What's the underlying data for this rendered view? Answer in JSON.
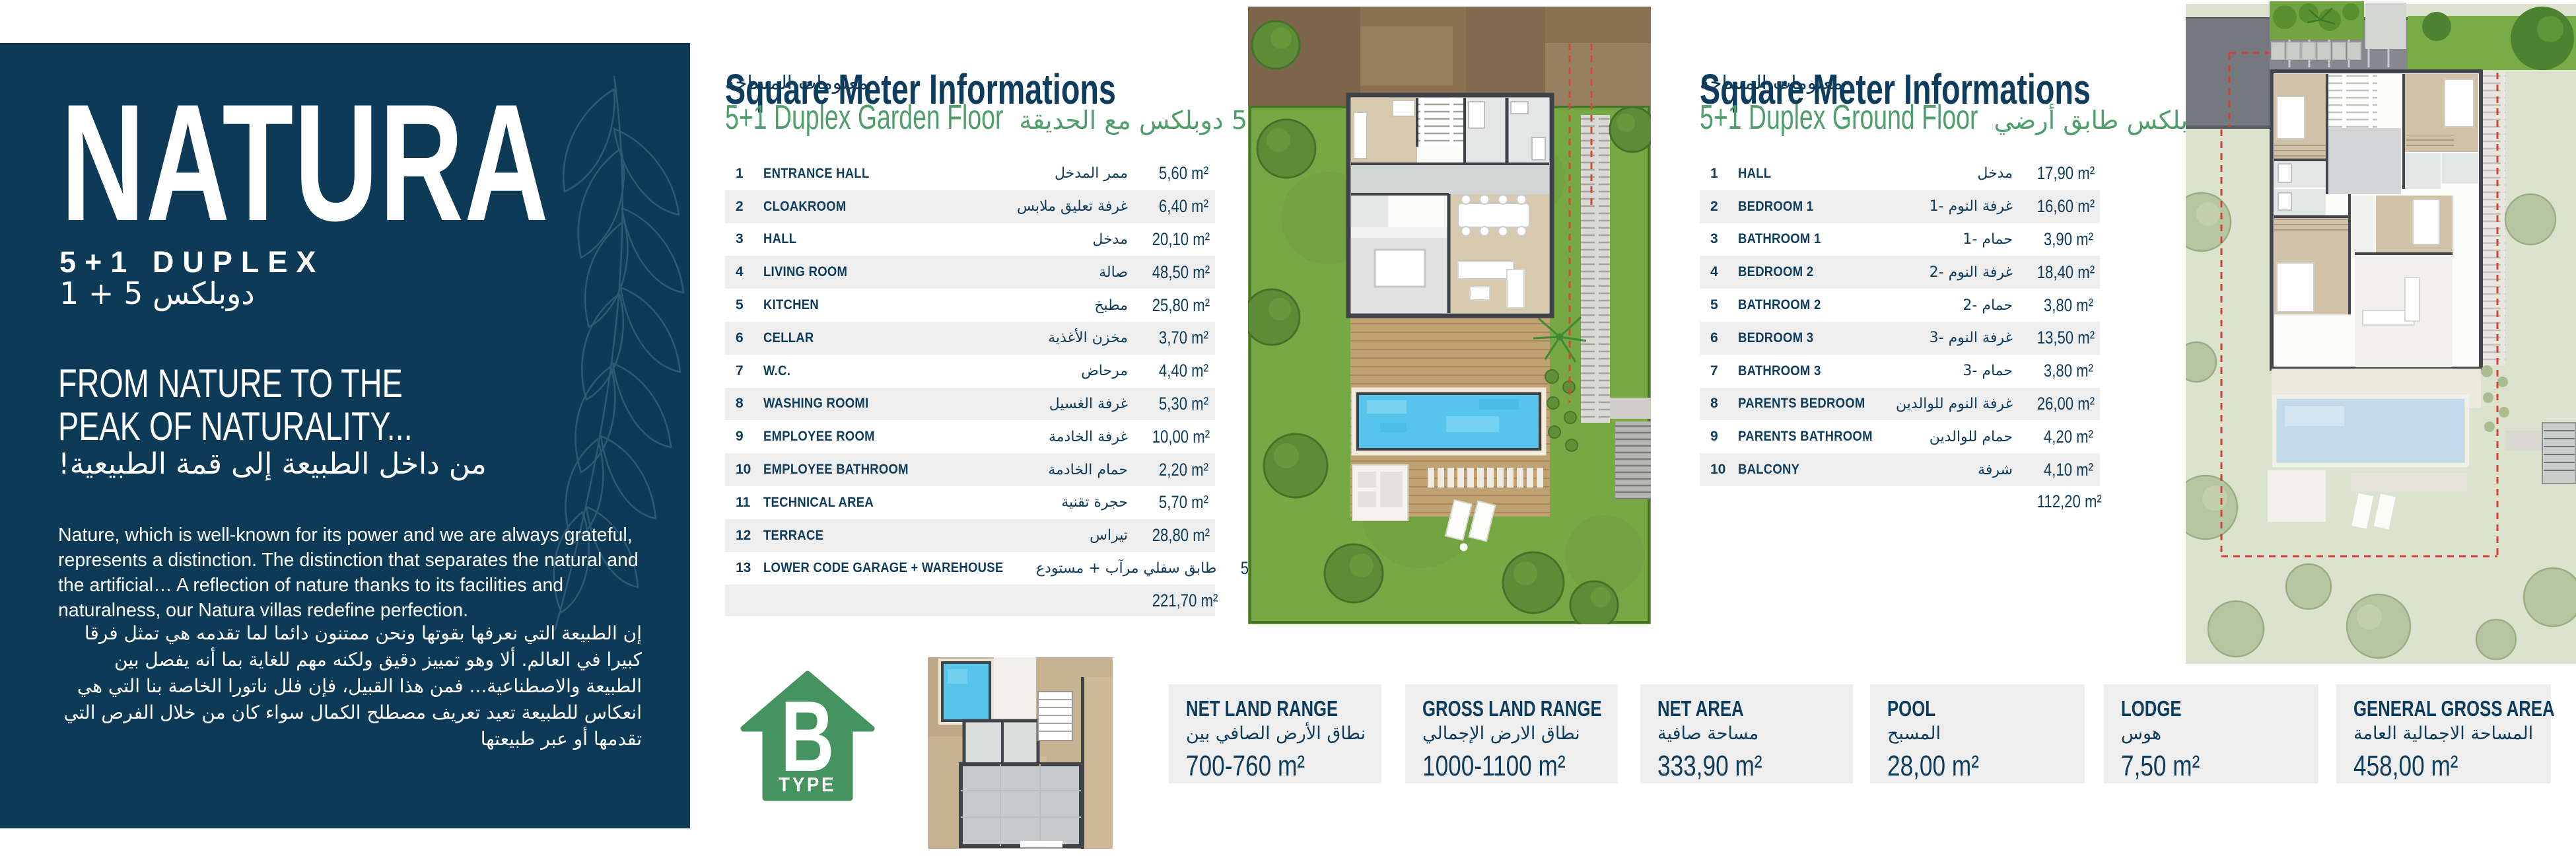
{
  "colors": {
    "navy": "#0d3a56",
    "heading_green": "#4f9e6c",
    "badge_green": "#45935f",
    "row_stripe": "#eeeeef",
    "box_background": "#eeeeef",
    "garden_green": "#76a844",
    "pool_blue": "#58c6ec"
  },
  "left_panel": {
    "title": "NATURA",
    "type_line": "5+1 DUPLEX",
    "type_line_ar": "دوبلكس 5 + 1",
    "headline1": "FROM NATURE TO THE",
    "headline2": "PEAK OF NATURALITY...",
    "headline_ar": "من داخل الطبيعة إلى قمة الطبيعية!",
    "body_en": "Nature, which is well-known for its power and we are always grateful, represents a distinction. The distinction that separates the natural and the artificial…  A reflection of nature thanks to its facilities and naturalness, our Natura villas redefine perfection.",
    "body_ar": "إن الطبيعة التي نعرفها بقوتها ونحن ممتنون دائما لما تقدمه هي تمثل فرقا كبيرا في العالم. ألا وهو تمييز دقيق ولكنه مهم للغاية بما أنه يفصل بين الطبيعة والاصطناعية... فمن هذا القبيل، فإن فلل ناتورا الخاصة بنا التي هي انعكاس للطبيعة تعيد تعريف مصطلح الكمال سواء كان من خلال الفرص التي تقدمها أو عبر طبيعتها"
  },
  "garden_floor": {
    "heading": "Square Meter Informations",
    "heading_ar": "معلومات المساحة",
    "floor": "5+1 Duplex Garden Floor",
    "floor_ar": "5+1 دوبلكس مع الحديقة",
    "rows": [
      {
        "num": "1",
        "name": "ENTRANCE HALL",
        "name_ar": "ممر المدخل",
        "area": "5,60 m²"
      },
      {
        "num": "2",
        "name": "CLOAKROOM",
        "name_ar": "غرفة تعليق ملابس",
        "area": "6,40 m²"
      },
      {
        "num": "3",
        "name": "HALL",
        "name_ar": "مدخل",
        "area": "20,10 m²"
      },
      {
        "num": "4",
        "name": "LIVING ROOM",
        "name_ar": "صالة",
        "area": "48,50 m²"
      },
      {
        "num": "5",
        "name": "KITCHEN",
        "name_ar": "مطبخ",
        "area": "25,80 m²"
      },
      {
        "num": "6",
        "name": "CELLAR",
        "name_ar": "مخزن الأغذية",
        "area": "3,70 m²"
      },
      {
        "num": "7",
        "name": "W.C.",
        "name_ar": "مرحاض",
        "area": "4,40 m²"
      },
      {
        "num": "8",
        "name": "WASHING ROOMI",
        "name_ar": "غرفة الغسيل",
        "area": "5,30 m²"
      },
      {
        "num": "9",
        "name": "EMPLOYEE ROOM",
        "name_ar": "غرفة الخادمة",
        "area": "10,00 m²"
      },
      {
        "num": "10",
        "name": "EMPLOYEE BATHROOM",
        "name_ar": "حمام الخادمة",
        "area": "2,20 m²"
      },
      {
        "num": "11",
        "name": "TECHNICAL AREA",
        "name_ar": "حجرة تقنية",
        "area": "5,70 m²"
      },
      {
        "num": "12",
        "name": "TERRACE",
        "name_ar": "تيراس",
        "area": "28,80 m²"
      },
      {
        "num": "13",
        "name": "LOWER CODE GARAGE + WAREHOUSE",
        "name_ar": "طابق سفلي مرآب + مستودع",
        "area": "55,20 m²"
      }
    ],
    "total": "221,70 m²"
  },
  "ground_floor": {
    "heading": "Square Meter Informations",
    "heading_ar": "معلومات المساحة",
    "floor": "5+1 Duplex Ground Floor",
    "floor_ar": "5+1 دوبلكس طابق أرضي",
    "rows": [
      {
        "num": "1",
        "name": "HALL",
        "name_ar": "مدخل",
        "area": "17,90 m²"
      },
      {
        "num": "2",
        "name": "BEDROOM 1",
        "name_ar": "غرفة النوم -1",
        "area": "16,60 m²"
      },
      {
        "num": "3",
        "name": "BATHROOM 1",
        "name_ar": "حمام -1",
        "area": "3,90 m²"
      },
      {
        "num": "4",
        "name": "BEDROOM 2",
        "name_ar": "غرفة النوم -2",
        "area": "18,40 m²"
      },
      {
        "num": "5",
        "name": "BATHROOM 2",
        "name_ar": "حمام -2",
        "area": "3,80 m²"
      },
      {
        "num": "6",
        "name": "BEDROOM 3",
        "name_ar": "غرفة النوم -3",
        "area": "13,50 m²"
      },
      {
        "num": "7",
        "name": "BATHROOM 3",
        "name_ar": "حمام -3",
        "area": "3,80 m²"
      },
      {
        "num": "8",
        "name": "PARENTS BEDROOM",
        "name_ar": "غرفة النوم للوالدين",
        "area": "26,00 m²"
      },
      {
        "num": "9",
        "name": "PARENTS BATHROOM",
        "name_ar": "حمام للوالدين",
        "area": "4,20 m²"
      },
      {
        "num": "10",
        "name": "BALCONY",
        "name_ar": "شرفة",
        "area": "4,10 m²"
      }
    ],
    "total": "112,20 m²"
  },
  "type_badge": {
    "letter": "B",
    "word": "TYPE"
  },
  "summary_boxes": [
    {
      "title": "NET LAND RANGE",
      "title_ar": "نطاق الأرض الصافي بين",
      "value": "700-760 m²"
    },
    {
      "title": "GROSS LAND RANGE",
      "title_ar": "نطاق الارض الإجمالي",
      "value": "1000-1100 m²"
    },
    {
      "title": "NET AREA",
      "title_ar": "مساحة صافية",
      "value": "333,90 m²"
    },
    {
      "title": "POOL",
      "title_ar": "المسبح",
      "value": "28,00 m²"
    },
    {
      "title": "LODGE",
      "title_ar": "هوس",
      "value": "7,50 m²"
    },
    {
      "title": "GENERAL GROSS AREA",
      "title_ar": "المساحة الاجمالية العامة",
      "value": "458,00 m²"
    }
  ]
}
